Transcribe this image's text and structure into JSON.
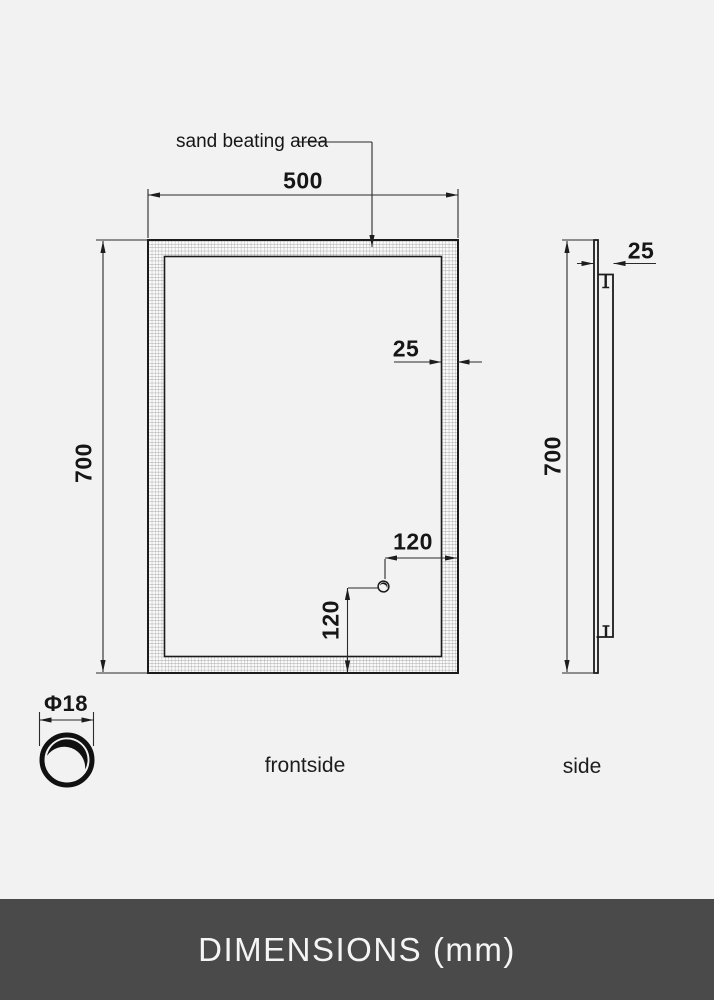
{
  "drawing": {
    "annotation": "sand beating area",
    "front_view": {
      "caption": "frontside",
      "width_mm": "500",
      "height_mm": "700",
      "frame_width_mm": "25",
      "button_offset_right_mm": "120",
      "button_offset_bottom_mm": "120"
    },
    "side_view": {
      "caption": "side",
      "depth_mm": "25",
      "height_mm": "700"
    },
    "button_detail": {
      "diameter_label": "Φ18"
    }
  },
  "footer": {
    "title": "DIMENSIONS (mm)"
  },
  "colors": {
    "background": "#f2f2f2",
    "outline": "#1b1b1b",
    "dimension_line": "#2b2b2b",
    "hatch_grid": "#8e8e8e",
    "footer_background": "#4a4a4a",
    "footer_text": "#f5f5f5"
  }
}
